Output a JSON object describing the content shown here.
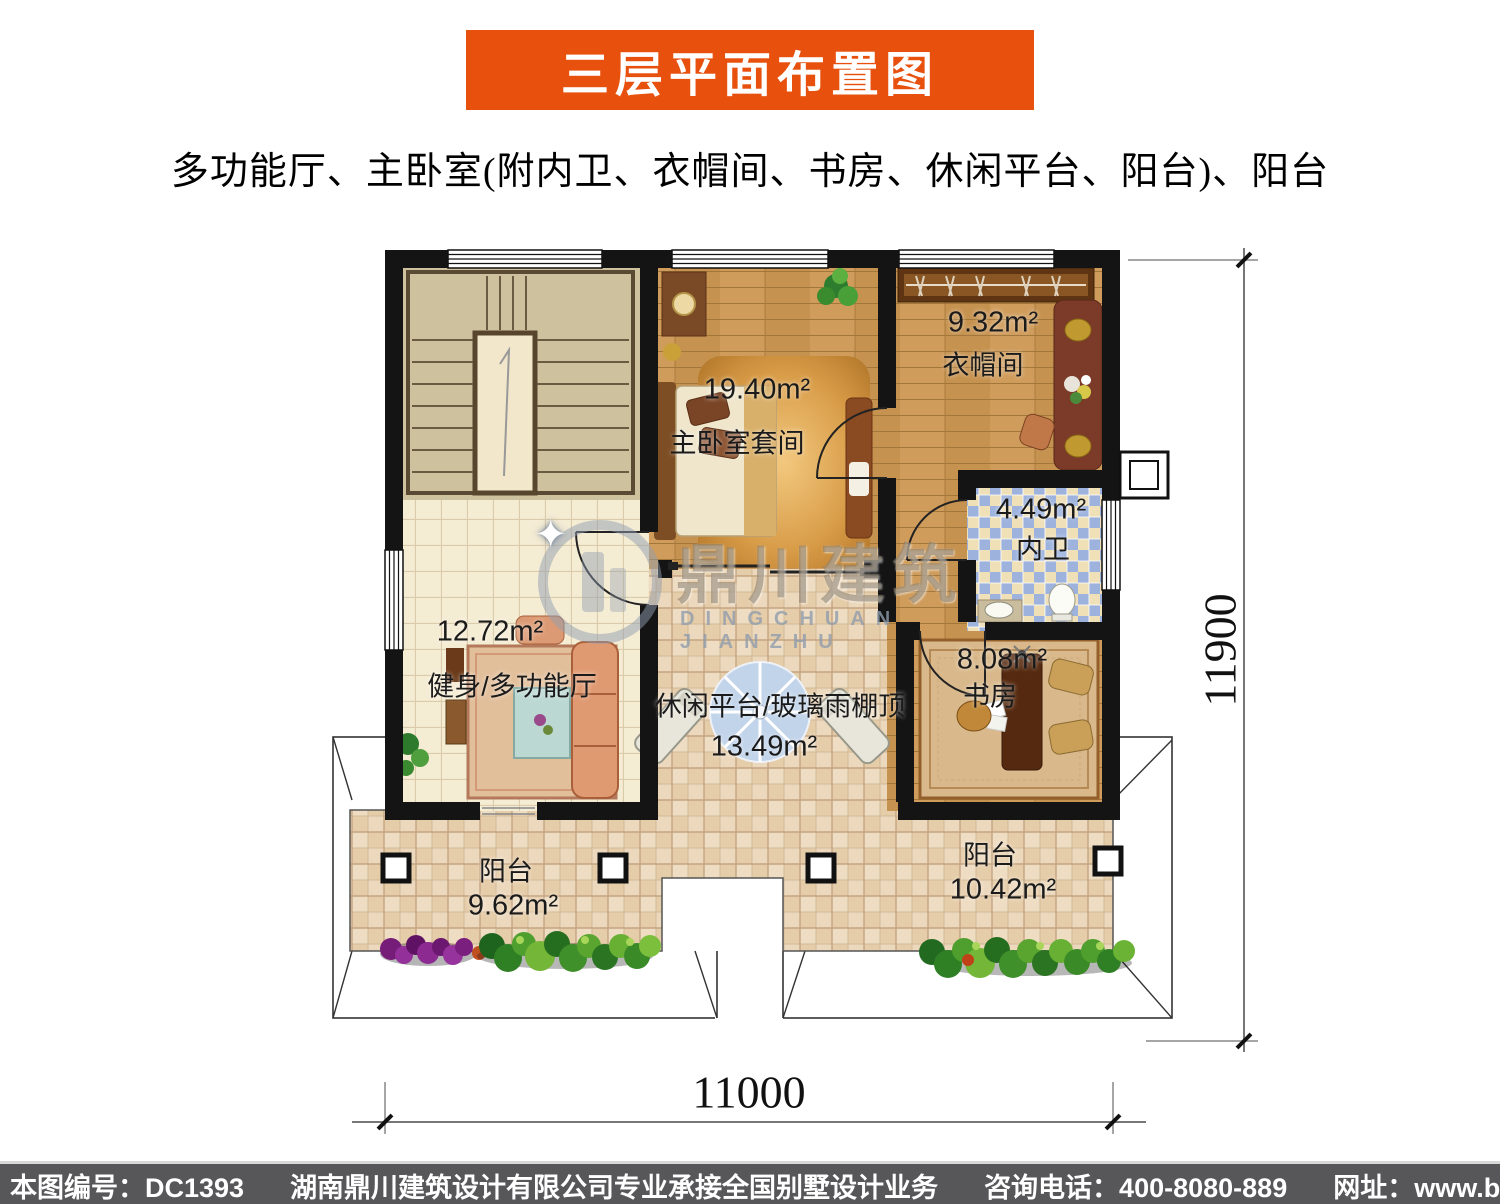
{
  "banner": {
    "title": "三层平面布置图"
  },
  "subtitle": "多功能厅、主卧室(附内卫、衣帽间、书房、休闲平台、阳台)、阳台",
  "plan": {
    "rooms": [
      {
        "id": "gym",
        "name": "健身/多功能厅",
        "area": "12.72m²"
      },
      {
        "id": "master",
        "name": "主卧室套间",
        "area": "19.40m²"
      },
      {
        "id": "cloak",
        "name": "衣帽间",
        "area": "9.32m²"
      },
      {
        "id": "bath",
        "name": "内卫",
        "area": "4.49m²"
      },
      {
        "id": "study",
        "name": "书房",
        "area": "8.08m²"
      },
      {
        "id": "platform",
        "name": "休闲平台/玻璃雨棚顶",
        "area": "13.49m²"
      },
      {
        "id": "balcony-left",
        "name": "阳台",
        "area": "9.62m²"
      },
      {
        "id": "balcony-right",
        "name": "阳台",
        "area": "10.42m²"
      }
    ],
    "dimensions": {
      "bottom": "11000",
      "right": "11900"
    }
  },
  "watermark": {
    "cn": "鼎川建筑",
    "en": "DINGCHUAN JIANZHU"
  },
  "footer": {
    "items": [
      "本图编号：DC1393",
      "湖南鼎川建筑设计有限公司专业承接全国别墅设计业务",
      "咨询电话：400-8080-889",
      "网址：www.bstzcs.com"
    ]
  },
  "colors": {
    "banner": "#e8500d",
    "footer_bg": "#575659",
    "wall": "#141414"
  }
}
